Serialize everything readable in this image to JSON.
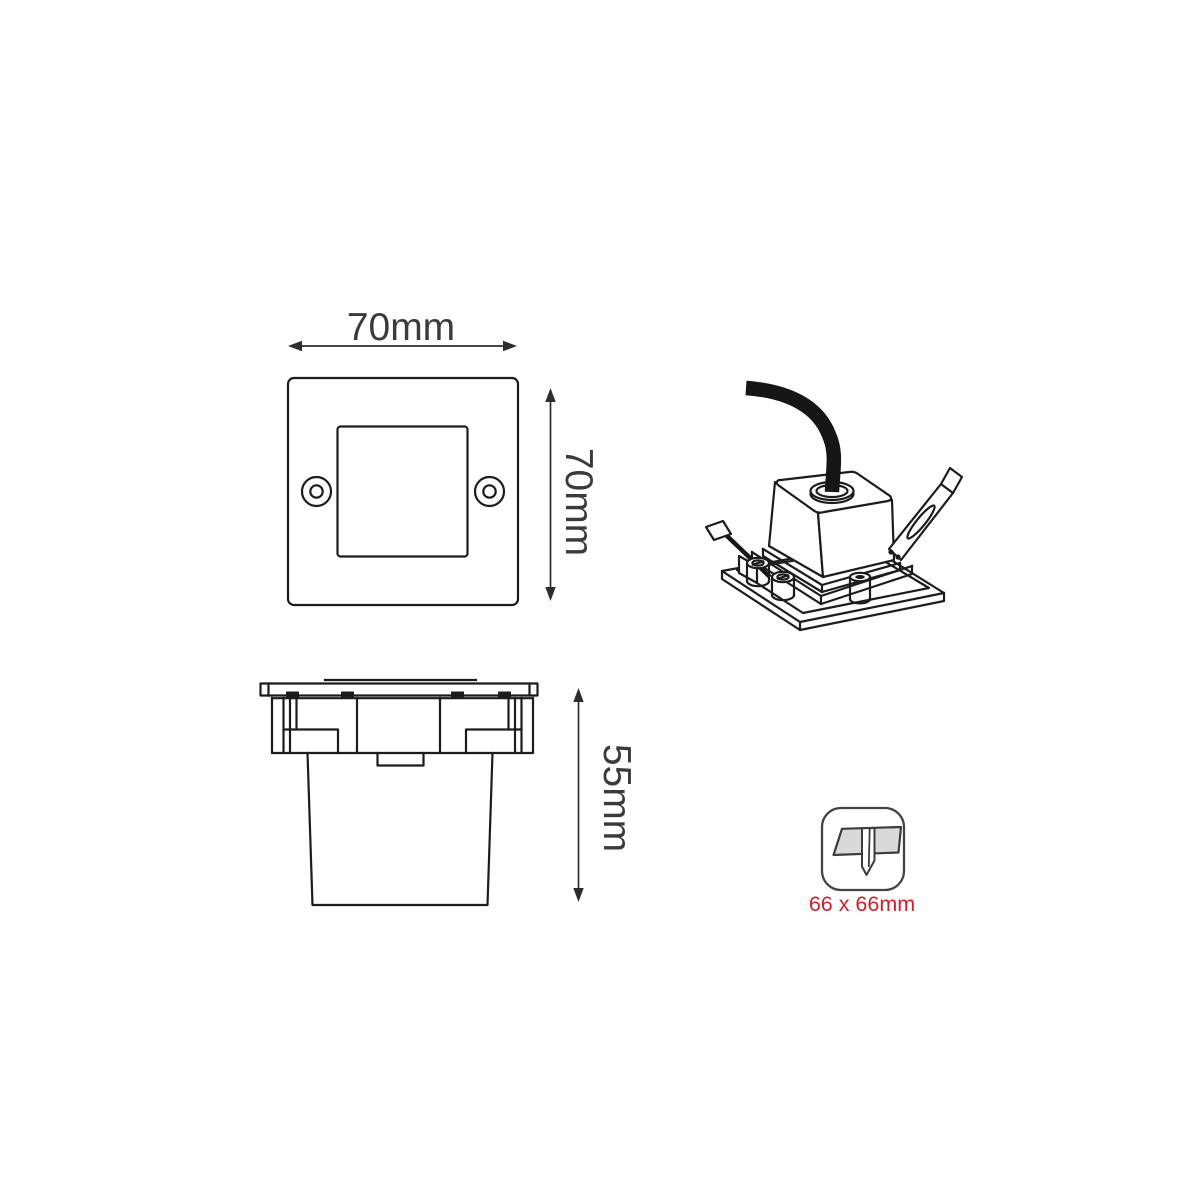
{
  "front_view": {
    "width_label": "70mm",
    "height_label": "70mm"
  },
  "side_view": {
    "height_label": "55mm"
  },
  "cutout_badge": {
    "size_label": "66 x 66mm"
  },
  "colors": {
    "background": "#ffffff",
    "line": "#1c1c1c",
    "dimension_text": "#3a3a3a",
    "cutout_text": "#cc2127",
    "cutout_panel_fill": "#d9d9d9",
    "cable": "#161616"
  },
  "icons": {
    "cutout_icon": "recessed-cutout-icon",
    "width_arrow": "horizontal-dimension-arrow-icon",
    "height_arrow": "vertical-dimension-arrow-icon",
    "depth_arrow": "vertical-dimension-arrow-icon"
  }
}
